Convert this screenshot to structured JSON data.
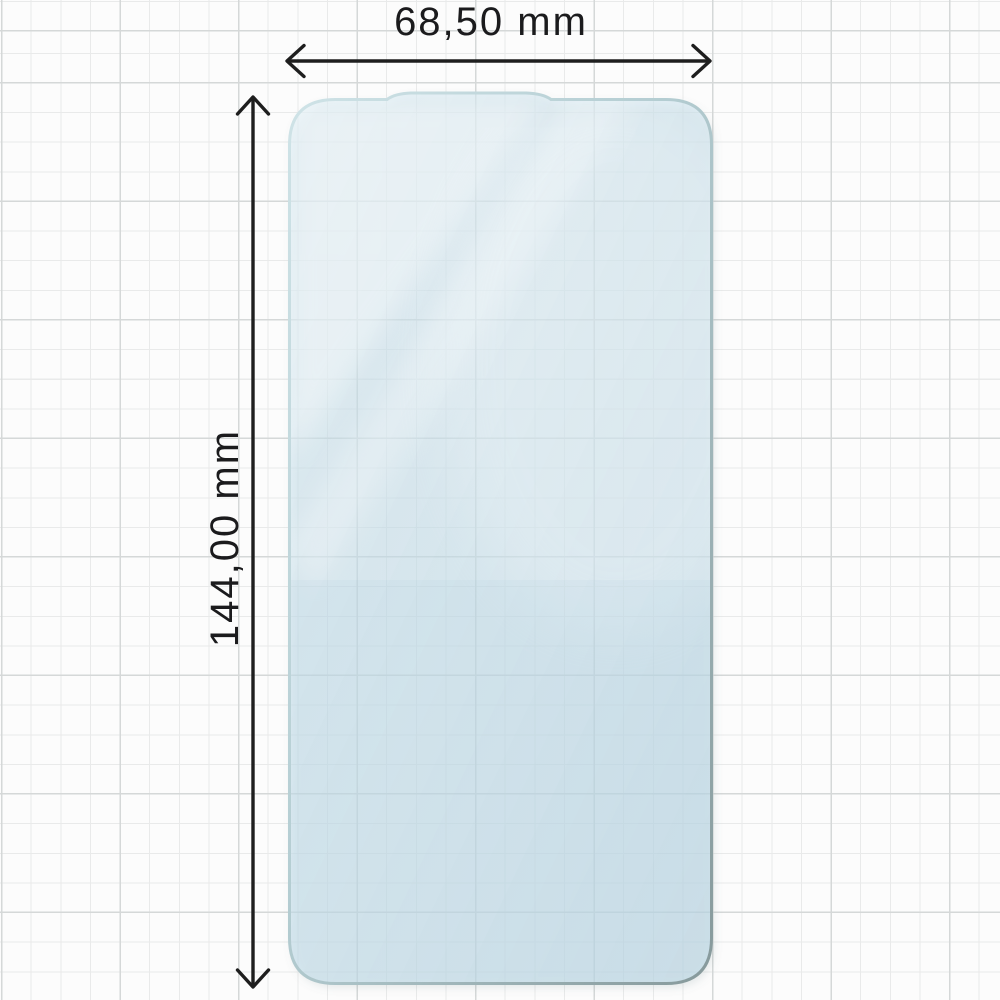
{
  "diagram": {
    "object": "screen-protector-film",
    "dimensions": {
      "width_label": "68,50 mm",
      "height_label": "144,00 mm"
    }
  },
  "colors": {
    "background": "#fcfcfc",
    "grid_minor": "#e9eaea",
    "grid_major": "#d5d8d8",
    "film_tint": "#e9f2f7",
    "film_edge_light": "#cfe3e7",
    "film_edge_dark": "#86999b",
    "dimension_line": "#1e1e1e",
    "label_text": "#1b1b1d"
  }
}
